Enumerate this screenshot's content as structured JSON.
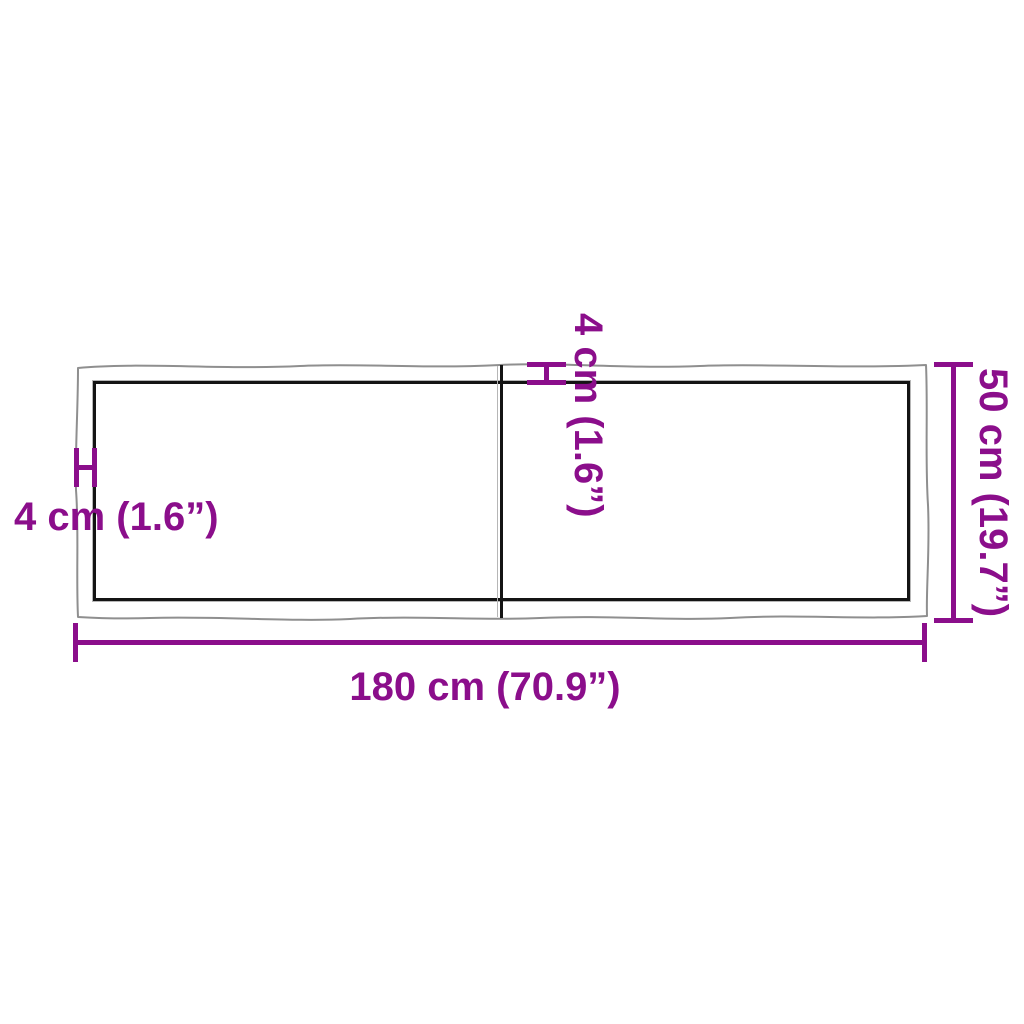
{
  "diagram": {
    "kind": "tabletop-dimension-diagram",
    "background": "#ffffff",
    "colors": {
      "dimension_accent": "#8B0E8B",
      "live_edge_outline": "#8f8f8f",
      "panel_border": "#141414"
    },
    "labels": {
      "width": "180 cm (70.9”)",
      "depth": "50 cm (19.7”)",
      "thickness_left": "4 cm (1.6”)",
      "thickness_top": "4 cm (1.6”)"
    },
    "measurements": {
      "width_cm": 180,
      "width_in": 70.9,
      "depth_cm": 50,
      "depth_in": 19.7,
      "thickness_cm": 4,
      "thickness_in": 1.6
    }
  }
}
